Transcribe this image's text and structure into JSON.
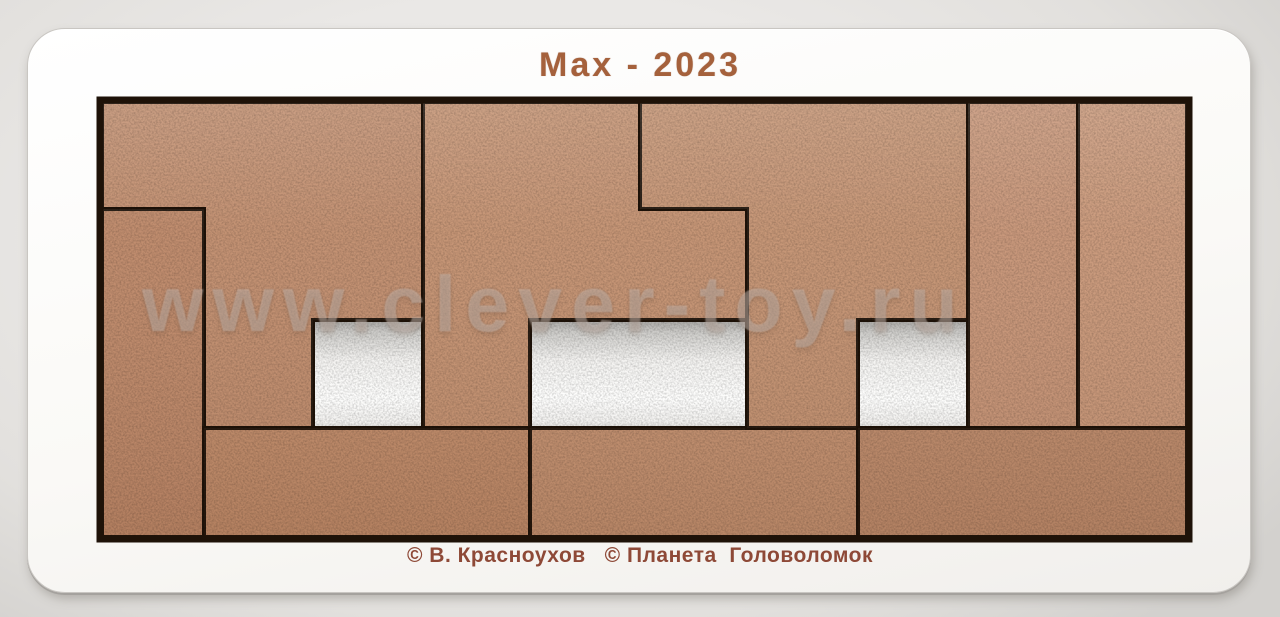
{
  "title": "Max - 2023",
  "watermark": "www.clever-toy.ru",
  "credits": "© В. Красноухов   © Планета  Головоломок",
  "colors": {
    "background": "#eae8e6",
    "tray": "#fbfaf7",
    "cut_line": "#1e1208",
    "title_text": "#a5613c",
    "credits_text": "#8e4937",
    "hole_floor_shadow": "#a8a6a3",
    "hole_floor_white": "#fdfdfc",
    "wood_base": "#c18f70"
  },
  "puzzle": {
    "grid": {
      "cols": 10,
      "rows": 4,
      "unit_px": 108
    },
    "recess": {
      "x": 102,
      "y": 102,
      "w": 1085,
      "h": 435
    },
    "holes": [
      {
        "name": "left-square-hole",
        "x": 313,
        "y": 320,
        "w": 110,
        "h": 108
      },
      {
        "name": "center-rectangle-hole",
        "x": 530,
        "y": 320,
        "w": 217,
        "h": 108
      },
      {
        "name": "right-square-hole",
        "x": 858,
        "y": 320,
        "w": 110,
        "h": 108
      }
    ],
    "pieces": [
      {
        "id": "A",
        "name": "top-left-step-piece",
        "fill": "#c08c6c",
        "points": [
          [
            102,
            102
          ],
          [
            423,
            102
          ],
          [
            423,
            320
          ],
          [
            313,
            320
          ],
          [
            313,
            428
          ],
          [
            204,
            428
          ],
          [
            204,
            209
          ],
          [
            102,
            209
          ]
        ]
      },
      {
        "id": "B",
        "name": "left-column-piece",
        "fill": "#bd8767",
        "points": [
          [
            102,
            209
          ],
          [
            204,
            209
          ],
          [
            204,
            537
          ],
          [
            102,
            537
          ]
        ]
      },
      {
        "id": "C",
        "name": "top-center-step-piece",
        "fill": "#c3906f",
        "points": [
          [
            423,
            102
          ],
          [
            640,
            102
          ],
          [
            640,
            209
          ],
          [
            747,
            209
          ],
          [
            747,
            320
          ],
          [
            530,
            320
          ],
          [
            530,
            428
          ],
          [
            423,
            428
          ]
        ]
      },
      {
        "id": "D",
        "name": "bottom-left-bar-piece",
        "fill": "#bf8a68",
        "points": [
          [
            204,
            428
          ],
          [
            530,
            428
          ],
          [
            530,
            537
          ],
          [
            204,
            537
          ]
        ]
      },
      {
        "id": "E",
        "name": "bottom-center-bar-piece",
        "fill": "#c28f6e",
        "points": [
          [
            530,
            428
          ],
          [
            858,
            428
          ],
          [
            858,
            537
          ],
          [
            530,
            537
          ]
        ]
      },
      {
        "id": "F",
        "name": "top-right-step-piece",
        "fill": "#c39170",
        "points": [
          [
            640,
            102
          ],
          [
            968,
            102
          ],
          [
            968,
            320
          ],
          [
            858,
            320
          ],
          [
            858,
            428
          ],
          [
            747,
            428
          ],
          [
            747,
            209
          ],
          [
            640,
            209
          ]
        ]
      },
      {
        "id": "G",
        "name": "right-column-piece-1",
        "fill": "#c69375",
        "points": [
          [
            968,
            102
          ],
          [
            1078,
            102
          ],
          [
            1078,
            428
          ],
          [
            968,
            428
          ]
        ]
      },
      {
        "id": "H",
        "name": "right-column-piece-2",
        "fill": "#c89677",
        "points": [
          [
            1078,
            102
          ],
          [
            1187,
            102
          ],
          [
            1187,
            428
          ],
          [
            1078,
            428
          ]
        ]
      },
      {
        "id": "I",
        "name": "bottom-right-bar-piece",
        "fill": "#bd8a6a",
        "points": [
          [
            858,
            428
          ],
          [
            1187,
            428
          ],
          [
            1187,
            537
          ],
          [
            858,
            537
          ]
        ]
      }
    ]
  }
}
